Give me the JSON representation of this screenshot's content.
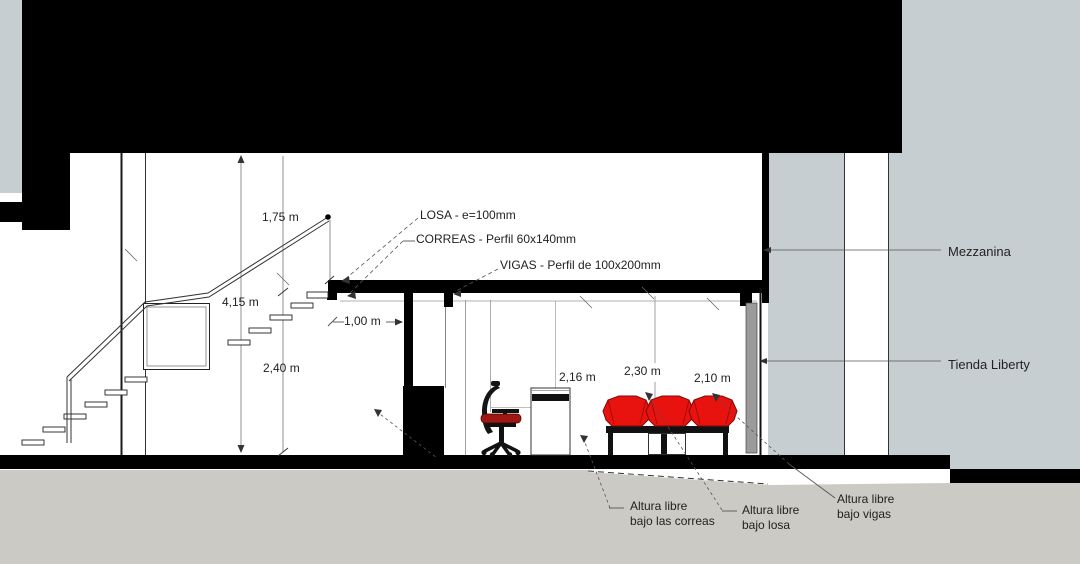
{
  "callouts": {
    "losa": "LOSA - e=100mm",
    "correas": "CORREAS - Perfil 60x140mm",
    "vigas": "VIGAS - Perfil de 100x200mm"
  },
  "dimensions": {
    "rail_height": "1,75 m",
    "overall_height": "4,15 m",
    "stair_gap": "1,00 m",
    "mezzanine_clear": "2,40 m",
    "clear_under_correas": "2,16 m",
    "clear_under_losa": "2,30 m",
    "clear_under_vigas": "2,10 m"
  },
  "zones": {
    "mezzanine": "Mezzanina",
    "store": "Tienda Liberty"
  },
  "clearance_labels": {
    "under_correas": {
      "line1": "Altura libre",
      "line2": "bajo las correas"
    },
    "under_losa": {
      "line1": "Altura libre",
      "line2": "bajo losa"
    },
    "under_vigas": {
      "line1": "Altura libre",
      "line2": "bajo vigas"
    }
  },
  "colors": {
    "chair_red": "#e8120e",
    "seat_red": "#9e1712",
    "ground_gray": "#cbcac4",
    "panel_gray": "#c7ced2",
    "wall_gray": "#9b9b9b",
    "ink": "#222222"
  }
}
